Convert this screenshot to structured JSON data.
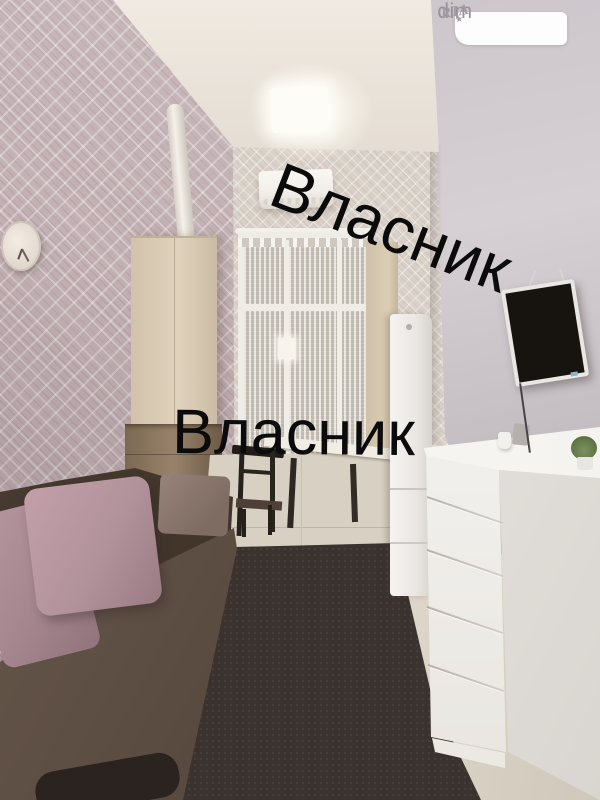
{
  "photo": {
    "alt": "Interior photo of a small studio room: sofa with pink pillows, wardrobe, lace-curtained window with air conditioner above, refrigerator, white chest of drawers, wall-mounted TV, dark carpet",
    "objects": [
      "wall-clock",
      "heating-pipe",
      "ceiling-light",
      "air-conditioner",
      "window-lace-curtains",
      "wardrobe",
      "refrigerator",
      "dining-table",
      "chair",
      "chest-of-drawers",
      "plant",
      "tv",
      "sofa",
      "pillows",
      "carpet",
      "tile-floor"
    ]
  },
  "watermarks": {
    "diagonal": "Власник",
    "horizontal": "Власник",
    "color": "#0b0b0b"
  },
  "badge": {
    "left": "dim",
    "right": "RIA",
    "star": "★",
    "bg": "#ffffff",
    "text_color": "#97929b"
  },
  "palette": {
    "left_wall": "#c2b0b3",
    "back_wall": "#d9d0c7",
    "right_wall": "#c9c2c7",
    "ceiling": "#ece5dc",
    "wardrobe": "#d9cab3",
    "wardrobe_base": "#8b7760",
    "sofa_seat": "#5e4f44",
    "sofa_back": "#40352b",
    "pillow": "#b2939c",
    "cushion": "#8a766b",
    "carpet": "#39322e",
    "tile_floor": "#d7d0c3",
    "fridge": "#efedea",
    "dresser": "#f5f3ef",
    "tv_screen": "#17140f"
  }
}
